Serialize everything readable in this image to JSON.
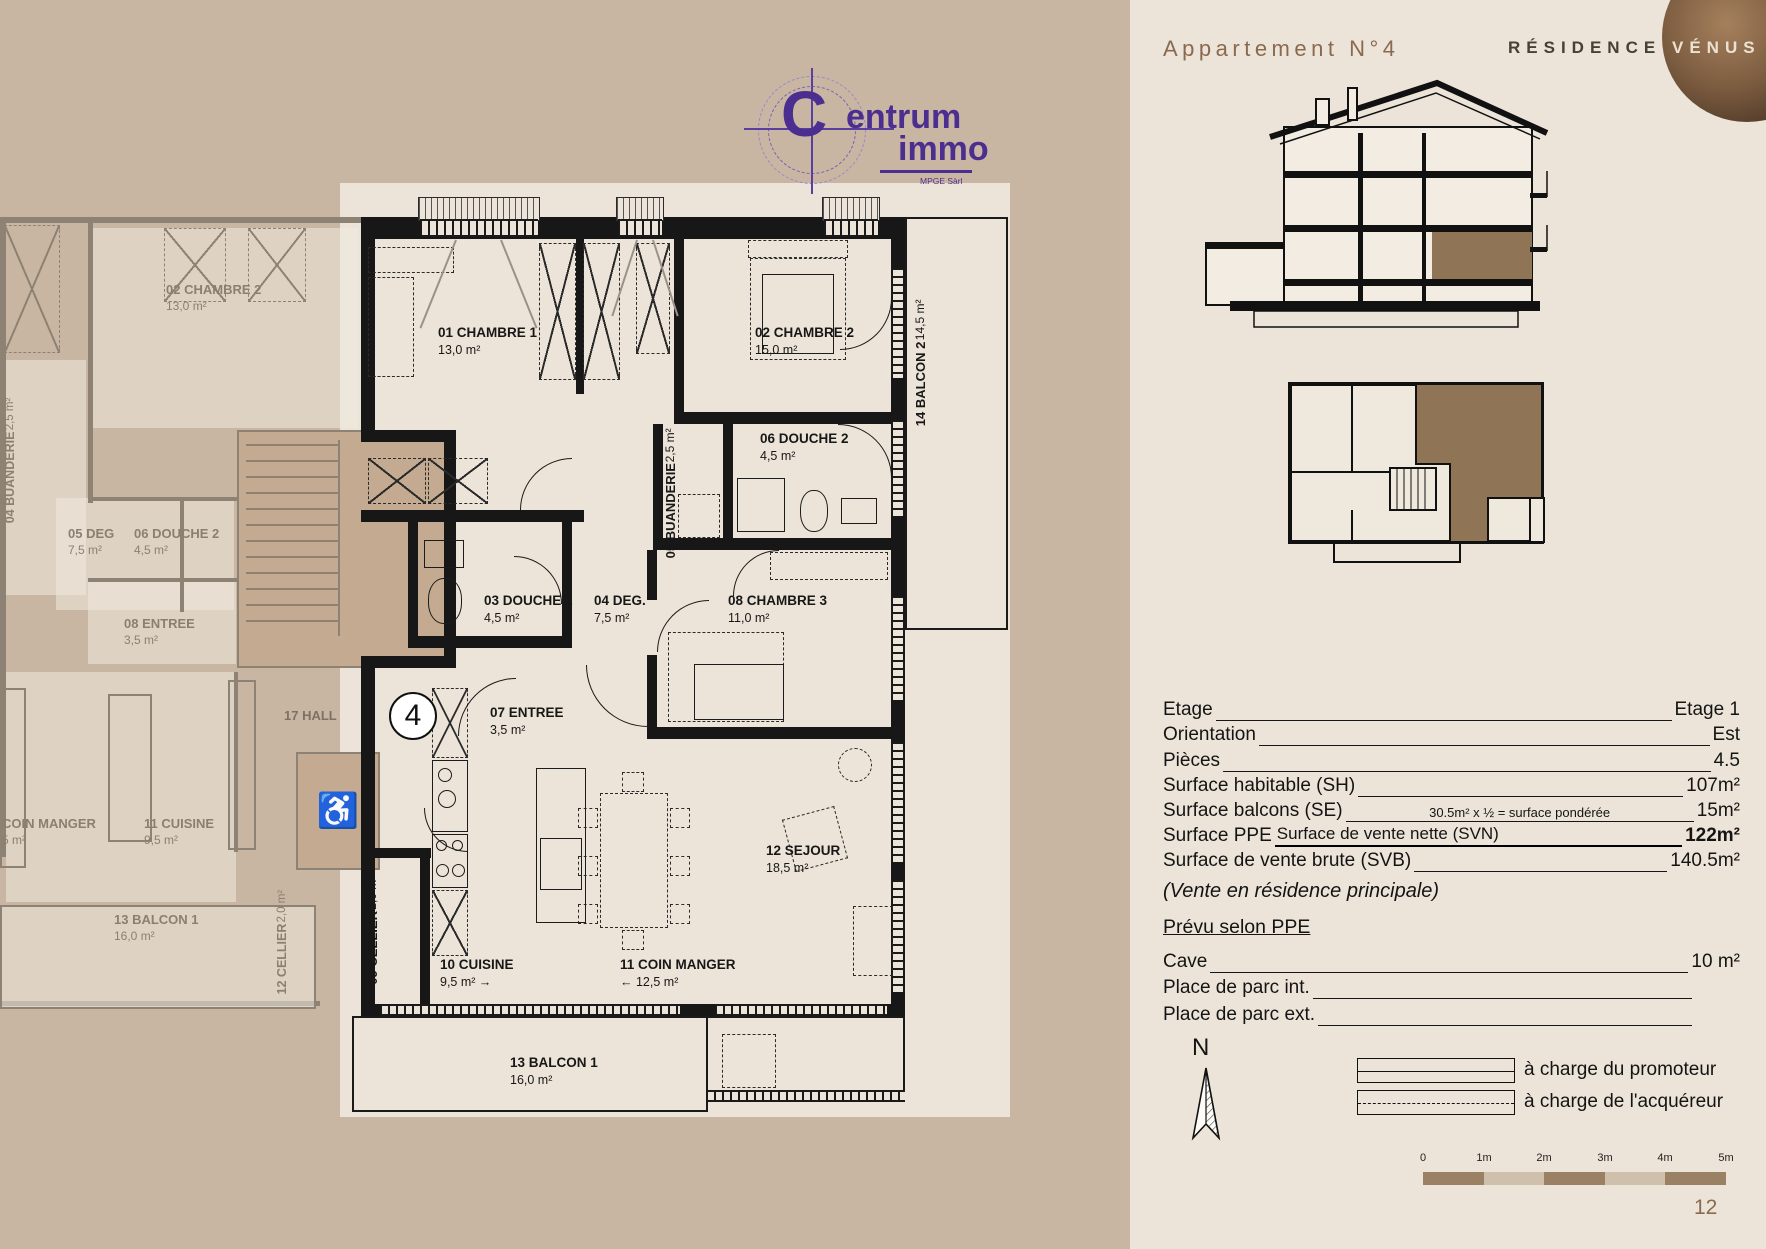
{
  "header": {
    "title": "Appartement N°4",
    "brand_left": "RÉSIDENCE",
    "brand_right": "VÉNUS"
  },
  "logo": {
    "initial": "C",
    "word1": "entrum",
    "word2": "immo",
    "subtitle": "MPGE Sàrl"
  },
  "plan": {
    "unit_badge": "4",
    "arrow_right": "→",
    "arrow_left": "←",
    "rooms": [
      {
        "name": "01 CHAMBRE 1",
        "area": "13,0 m²"
      },
      {
        "name": "02 CHAMBRE 2",
        "area": "15,0 m²"
      },
      {
        "name": "03 DOUCHE 1",
        "area": "4,5 m²"
      },
      {
        "name": "04 DEG.",
        "area": "7,5 m²"
      },
      {
        "name": "05 BUANDERIE",
        "area": "2,5 m²"
      },
      {
        "name": "06 DOUCHE 2",
        "area": "4,5 m²"
      },
      {
        "name": "07 ENTREE",
        "area": "3,5 m²"
      },
      {
        "name": "08 CHAMBRE 3",
        "area": "11,0 m²"
      },
      {
        "name": "09 CELLIER",
        "area": "2,0 m²"
      },
      {
        "name": "10 CUISINE",
        "area": "9,5 m²"
      },
      {
        "name": "11 COIN MANGER",
        "area": "12,5 m²"
      },
      {
        "name": "12 SEJOUR",
        "area": "18,5 m²"
      },
      {
        "name": "13 BALCON 1",
        "area": "16,0 m²"
      },
      {
        "name": "14 BALCON 2",
        "area": "14,5 m²"
      }
    ],
    "faded_rooms": [
      {
        "name": "02 CHAMBRE 2",
        "area": "13,0 m²"
      },
      {
        "name": "04 BUANDERIE",
        "area": "2,5 m²"
      },
      {
        "name": "05 DEG",
        "area": "7,5 m²"
      },
      {
        "name": "06 DOUCHE 2",
        "area": "4,5 m²"
      },
      {
        "name": "08 ENTREE",
        "area": "3,5 m²"
      },
      {
        "name": "17 HALL",
        "area": ""
      },
      {
        "name": "COIN MANGER",
        "area": "5 m²"
      },
      {
        "name": "11 CUISINE",
        "area": "9,5 m²"
      },
      {
        "name": "12 CELLIER",
        "area": "2,0 m²"
      },
      {
        "name": "13 BALCON 1",
        "area": "16,0 m²"
      }
    ]
  },
  "details": {
    "rows": [
      {
        "label": "Etage",
        "value": "Etage 1"
      },
      {
        "label": "Orientation",
        "value": "Est"
      },
      {
        "label": "Pièces",
        "value": "4.5"
      },
      {
        "label": "Surface habitable (SH)",
        "value": "107m²"
      },
      {
        "label": "Surface balcons (SE)",
        "note": "30.5m² x ½ = surface pondérée",
        "value": "15m²"
      },
      {
        "label": "Surface PPE",
        "note": "Surface de vente nette (SVN)",
        "value": "122m²"
      },
      {
        "label": "Surface de vente brute (SVB)",
        "value": "140.5m²"
      }
    ],
    "vente_note": "(Vente en résidence principale)",
    "ppe_heading": "Prévu selon PPE",
    "ppe_rows": [
      {
        "label": "Cave",
        "value": "10 m²"
      },
      {
        "label": "Place de parc int.",
        "value": ""
      },
      {
        "label": "Place de parc ext.",
        "value": ""
      }
    ]
  },
  "compass": {
    "label": "N"
  },
  "legend": {
    "items": [
      {
        "label": "à charge du promoteur"
      },
      {
        "label": "à charge de l'acquéreur"
      }
    ]
  },
  "scalebar": {
    "ticks": [
      "0",
      "1m",
      "2m",
      "3m",
      "4m",
      "5m"
    ]
  },
  "page_number": "12"
}
